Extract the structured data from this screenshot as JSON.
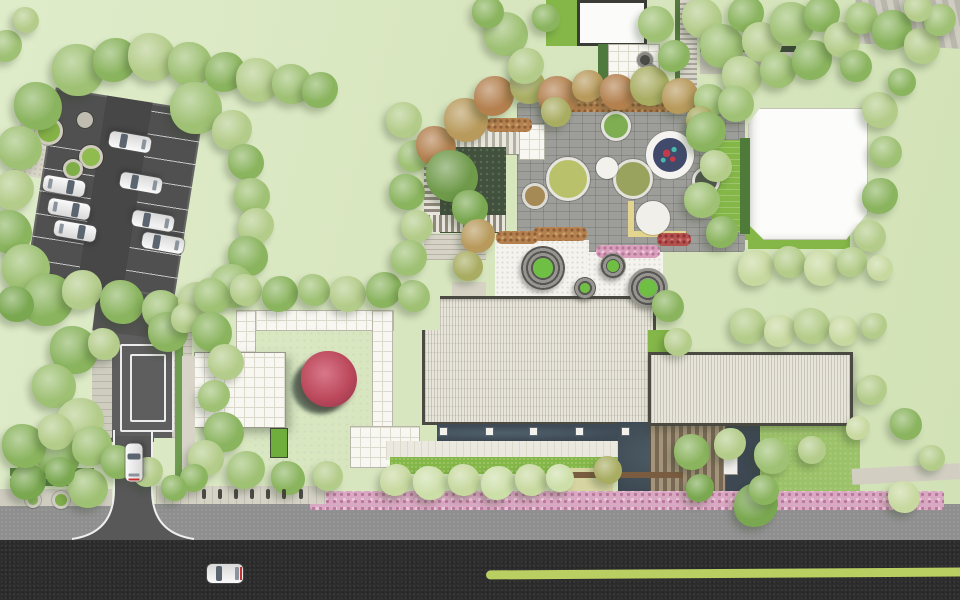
{
  "meta": {
    "title": "Residential landscape site plan — aerial color rendering",
    "canvas": {
      "width": 960,
      "height": 600
    }
  },
  "palette": {
    "grass": "#d8e6bf",
    "grassLight": "#dfecca",
    "roadDark": "#2d2d2d",
    "roadGray": "#8f8f8f",
    "roadEntry": "#585858",
    "parking": "#505050",
    "paveLight": "#d9d6c8",
    "white": "#f8f7f2",
    "whiteGrid": "#dcd9cd",
    "roofFill": "#e7e4d9",
    "roofEdge": "#4a4a42",
    "pool": "#46515d",
    "poolDeep": "#39434e",
    "water": "#3d4852",
    "channel": "#3e4a56",
    "plaza": "#9d9d99",
    "lawnBright": "#84b748",
    "lawnMid": "#9cc269",
    "hedge": "#5d8a43",
    "deckA": "#a4947c",
    "deckB": "#776853",
    "redTree": "#b84a5c",
    "redTreeDark": "#8e3347",
    "fountain": "#414a6b",
    "fountainRed": "#c43a4a",
    "fountainTeal": "#49b8ae",
    "moundDark": "#575652",
    "moundLight": "#96958f",
    "moundGreen": "#6fbf45",
    "yellow": "#e3d48e",
    "sand": "#d6d4a0",
    "greenLine": "#b9cf62"
  },
  "features": [
    "parking-lot",
    "entrance-road",
    "speed-table",
    "courtyard-pool",
    "red-maple",
    "main-building-roof",
    "south-wing-roof",
    "plaza-fountain",
    "spiral-mounds",
    "pavilion-roof",
    "villa-roof",
    "timber-deck",
    "flower-border",
    "street",
    "bike-lane-line"
  ],
  "scene": {
    "treeColors": [
      "#9fc174",
      "#8ab45e",
      "#b4cc8a",
      "#c8d9a0",
      "#7aa850",
      "#a9ad62",
      "#b89a5c",
      "#b3804e",
      "#6f9a4a",
      "#cddfa9"
    ],
    "trees": [
      [
        78,
        70,
        26,
        0
      ],
      [
        115,
        60,
        22,
        1
      ],
      [
        152,
        57,
        24,
        2
      ],
      [
        190,
        64,
        22,
        0
      ],
      [
        225,
        72,
        20,
        1
      ],
      [
        258,
        80,
        22,
        2
      ],
      [
        292,
        84,
        20,
        0
      ],
      [
        320,
        90,
        18,
        1
      ],
      [
        38,
        106,
        24,
        1
      ],
      [
        20,
        148,
        22,
        0
      ],
      [
        14,
        190,
        20,
        2
      ],
      [
        10,
        232,
        22,
        1
      ],
      [
        26,
        268,
        24,
        0
      ],
      [
        48,
        300,
        26,
        1
      ],
      [
        16,
        304,
        18,
        4
      ],
      [
        196,
        108,
        26,
        0
      ],
      [
        232,
        130,
        20,
        2
      ],
      [
        246,
        162,
        18,
        1
      ],
      [
        252,
        196,
        18,
        0
      ],
      [
        256,
        226,
        18,
        2
      ],
      [
        248,
        256,
        20,
        1
      ],
      [
        232,
        286,
        22,
        0
      ],
      [
        82,
        290,
        20,
        2
      ],
      [
        122,
        302,
        22,
        1
      ],
      [
        162,
        310,
        20,
        0
      ],
      [
        196,
        300,
        18,
        2
      ],
      [
        74,
        350,
        24,
        1
      ],
      [
        54,
        386,
        22,
        0
      ],
      [
        80,
        422,
        24,
        2
      ],
      [
        58,
        456,
        22,
        1
      ],
      [
        88,
        488,
        20,
        0
      ],
      [
        28,
        482,
        18,
        4
      ],
      [
        104,
        344,
        16,
        2
      ],
      [
        168,
        332,
        20,
        1
      ],
      [
        186,
        318,
        15,
        2
      ],
      [
        212,
        296,
        18,
        0
      ],
      [
        246,
        290,
        16,
        2
      ],
      [
        280,
        294,
        18,
        1
      ],
      [
        314,
        290,
        16,
        0
      ],
      [
        348,
        294,
        18,
        2
      ],
      [
        384,
        290,
        18,
        1
      ],
      [
        414,
        296,
        16,
        0
      ],
      [
        404,
        120,
        18,
        2
      ],
      [
        414,
        156,
        16,
        0
      ],
      [
        407,
        192,
        18,
        1
      ],
      [
        417,
        226,
        16,
        2
      ],
      [
        409,
        258,
        18,
        0
      ],
      [
        212,
        332,
        20,
        1
      ],
      [
        226,
        362,
        18,
        2
      ],
      [
        214,
        396,
        16,
        0
      ],
      [
        224,
        432,
        20,
        1
      ],
      [
        206,
        458,
        18,
        2
      ],
      [
        246,
        470,
        19,
        0
      ],
      [
        288,
        478,
        17,
        1
      ],
      [
        328,
        476,
        15,
        2
      ],
      [
        194,
        478,
        14,
        1
      ],
      [
        436,
        146,
        20,
        7
      ],
      [
        466,
        120,
        22,
        6
      ],
      [
        494,
        96,
        20,
        7
      ],
      [
        528,
        86,
        18,
        5
      ],
      [
        558,
        96,
        20,
        7
      ],
      [
        588,
        86,
        16,
        6
      ],
      [
        618,
        92,
        18,
        7
      ],
      [
        650,
        86,
        20,
        5
      ],
      [
        680,
        96,
        18,
        6
      ],
      [
        556,
        112,
        15,
        5
      ],
      [
        710,
        100,
        16,
        0
      ],
      [
        700,
        120,
        14,
        5
      ],
      [
        452,
        176,
        26,
        8
      ],
      [
        470,
        208,
        18,
        4
      ],
      [
        478,
        236,
        17,
        6
      ],
      [
        468,
        266,
        15,
        5
      ],
      [
        506,
        34,
        22,
        0
      ],
      [
        526,
        66,
        18,
        2
      ],
      [
        546,
        18,
        14,
        1
      ],
      [
        488,
        12,
        16,
        1
      ],
      [
        6,
        46,
        16,
        0
      ],
      [
        26,
        20,
        13,
        2
      ],
      [
        656,
        24,
        18,
        0
      ],
      [
        674,
        56,
        16,
        1
      ],
      [
        702,
        18,
        20,
        2
      ],
      [
        722,
        46,
        22,
        0
      ],
      [
        746,
        14,
        18,
        1
      ],
      [
        762,
        42,
        20,
        2
      ],
      [
        792,
        24,
        22,
        0
      ],
      [
        822,
        14,
        18,
        1
      ],
      [
        742,
        76,
        20,
        2
      ],
      [
        778,
        70,
        18,
        0
      ],
      [
        812,
        60,
        20,
        1
      ],
      [
        842,
        40,
        18,
        2
      ],
      [
        862,
        18,
        16,
        0
      ],
      [
        892,
        30,
        20,
        1
      ],
      [
        922,
        46,
        18,
        2
      ],
      [
        856,
        66,
        16,
        1
      ],
      [
        940,
        20,
        16,
        0
      ],
      [
        918,
        8,
        14,
        2
      ],
      [
        736,
        104,
        18,
        0
      ],
      [
        706,
        132,
        20,
        1
      ],
      [
        716,
        166,
        16,
        2
      ],
      [
        702,
        200,
        18,
        0
      ],
      [
        722,
        232,
        16,
        1
      ],
      [
        880,
        110,
        18,
        2
      ],
      [
        886,
        152,
        16,
        0
      ],
      [
        880,
        196,
        18,
        1
      ],
      [
        870,
        236,
        16,
        2
      ],
      [
        902,
        82,
        14,
        1
      ],
      [
        756,
        268,
        18,
        3
      ],
      [
        790,
        262,
        16,
        2
      ],
      [
        822,
        268,
        18,
        3
      ],
      [
        852,
        262,
        15,
        2
      ],
      [
        880,
        268,
        13,
        3
      ],
      [
        748,
        326,
        18,
        2
      ],
      [
        780,
        331,
        16,
        3
      ],
      [
        812,
        326,
        18,
        2
      ],
      [
        844,
        331,
        15,
        3
      ],
      [
        874,
        326,
        13,
        2
      ],
      [
        668,
        306,
        16,
        1
      ],
      [
        678,
        342,
        14,
        2
      ],
      [
        396,
        480,
        16,
        3
      ],
      [
        430,
        483,
        17,
        9
      ],
      [
        464,
        480,
        16,
        3
      ],
      [
        498,
        483,
        17,
        9
      ],
      [
        531,
        480,
        16,
        3
      ],
      [
        560,
        478,
        14,
        9
      ],
      [
        756,
        505,
        22,
        4
      ],
      [
        904,
        497,
        16,
        3
      ],
      [
        692,
        452,
        18,
        1
      ],
      [
        730,
        444,
        16,
        2
      ],
      [
        772,
        456,
        18,
        0
      ],
      [
        812,
        450,
        14,
        2
      ],
      [
        700,
        488,
        14,
        4
      ],
      [
        764,
        490,
        15,
        1
      ],
      [
        608,
        470,
        14,
        5
      ],
      [
        872,
        390,
        15,
        2
      ],
      [
        906,
        424,
        16,
        1
      ],
      [
        932,
        458,
        13,
        2
      ],
      [
        858,
        428,
        12,
        3
      ],
      [
        24,
        446,
        22,
        1
      ],
      [
        56,
        432,
        18,
        2
      ],
      [
        92,
        446,
        20,
        0
      ],
      [
        118,
        462,
        17,
        1
      ],
      [
        60,
        472,
        15,
        4
      ],
      [
        148,
        472,
        15,
        2
      ],
      [
        174,
        488,
        13,
        1
      ]
    ],
    "mounds": [
      [
        543,
        268,
        22
      ],
      [
        613,
        266,
        13
      ],
      [
        585,
        288,
        11
      ],
      [
        648,
        288,
        20
      ]
    ],
    "planters": [
      [
        613,
        123,
        12,
        "#e3e2db",
        "#7fae52"
      ],
      [
        565,
        176,
        19,
        "#e6e5de",
        "#b9c26a"
      ],
      [
        630,
        176,
        17,
        "#e3e2db",
        "#9aa35e"
      ],
      [
        532,
        193,
        10,
        "#dcdbd4",
        "#a58a55"
      ],
      [
        604,
        165,
        8,
        "#f2f1eb",
        "#f2f1eb"
      ],
      [
        703,
        178,
        11,
        "#e8e7e1",
        "#565b52"
      ],
      [
        650,
        215,
        14,
        "#f0efe9",
        "#f0efe9"
      ],
      [
        46,
        128,
        11,
        "#cfccbe",
        "#86b347"
      ],
      [
        88,
        154,
        9,
        "#cfccbe",
        "#8fbb4f"
      ],
      [
        70,
        166,
        7,
        "#cfccbe",
        "#7fae48"
      ],
      [
        82,
        117,
        5,
        "#c0bdb0",
        "#c0bdb0"
      ],
      [
        642,
        57,
        5,
        "#8a8a84",
        "#4a4a46"
      ],
      [
        647,
        69,
        5,
        "#8a8a84",
        "#4a4a46"
      ],
      [
        58,
        497,
        6,
        "#cfccc0",
        "#7fae4a"
      ],
      [
        30,
        497,
        5,
        "#cfccc0",
        "#8ab45e"
      ]
    ],
    "flowerPatches": [
      [
        533,
        227,
        54,
        14,
        "rust"
      ],
      [
        496,
        231,
        42,
        13,
        "rust"
      ],
      [
        596,
        245,
        64,
        13,
        "pink"
      ],
      [
        657,
        233,
        34,
        13,
        "red"
      ],
      [
        486,
        118,
        46,
        14,
        "rust"
      ],
      [
        540,
        96,
        160,
        16,
        "rust"
      ]
    ],
    "piers": {
      "y": 428,
      "xs": [
        440,
        486,
        530,
        576,
        622
      ]
    },
    "bikes": {
      "y": 489,
      "xs": [
        202,
        218,
        234,
        250,
        266,
        282,
        299
      ]
    },
    "ripples": {
      "cx": 66,
      "cy": 72,
      "radii": [
        26,
        50,
        74,
        98
      ]
    },
    "cars": [
      {
        "x": 64,
        "y": 186,
        "rot": 10,
        "len": 42,
        "wid": 16,
        "tail": false
      },
      {
        "x": 69,
        "y": 209,
        "rot": 10,
        "len": 42,
        "wid": 16,
        "tail": false
      },
      {
        "x": 75,
        "y": 231,
        "rot": 10,
        "len": 42,
        "wid": 16,
        "tail": false
      },
      {
        "x": 130,
        "y": 142,
        "rot": 190,
        "len": 42,
        "wid": 16,
        "tail": false
      },
      {
        "x": 141,
        "y": 183,
        "rot": 190,
        "len": 42,
        "wid": 16,
        "tail": false
      },
      {
        "x": 153,
        "y": 221,
        "rot": 190,
        "len": 42,
        "wid": 16,
        "tail": false
      },
      {
        "x": 163,
        "y": 243,
        "rot": 190,
        "len": 42,
        "wid": 16,
        "tail": false
      },
      {
        "x": 134,
        "y": 462,
        "rot": 270,
        "len": 38,
        "wid": 17,
        "tail": true
      },
      {
        "x": 225,
        "y": 573,
        "rot": 180,
        "len": 36,
        "wid": 19,
        "tail": true
      }
    ]
  }
}
